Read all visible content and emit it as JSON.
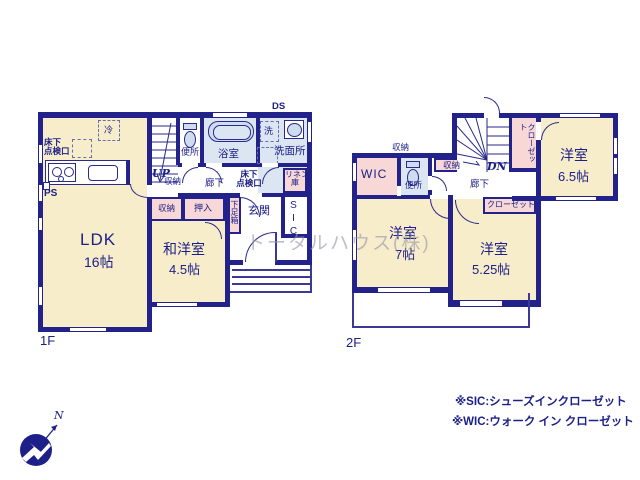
{
  "watermark": "トータルハウス(株)",
  "f1": {
    "floor_label": "1F",
    "ds": "DS",
    "rei": "冷",
    "yukashita_k_l1": "床下",
    "yukashita_k_l2": "点検口",
    "ps": "PS",
    "ldk_name": "LDK",
    "ldk_size": "16帖",
    "up": "UP",
    "shunou_stairs": "収納",
    "wc": "便所",
    "bath": "浴室",
    "laundry": "洗",
    "wash": "洗面所",
    "hall": "廊下",
    "yukashita_h_l1": "床下",
    "yukashita_h_l2": "点検口",
    "linen_l1": "リネン",
    "linen_l2": "庫",
    "shunou": "収納",
    "oshiire": "押入",
    "shoebox": "下足箱",
    "genkan": "玄関",
    "sic": "SIC",
    "wayo_name": "和洋室",
    "wayo_size": "4.5帖"
  },
  "f2": {
    "floor_label": "2F",
    "shunou_top": "収納",
    "wic": "WIC",
    "wc": "便所",
    "shunou_hall": "収納",
    "dn": "DN",
    "hall": "廊下",
    "closet_v": "クローゼット",
    "closet_h": "クローゼット",
    "room65_name": "洋室",
    "room65_size": "6.5帖",
    "room7_name": "洋室",
    "room7_size": "7帖",
    "room525_name": "洋室",
    "room525_size": "5.25帖"
  },
  "notes": {
    "sic": "※SIC:シューズインクローゼット",
    "wic": "※WIC:ウォーク イン クローゼット"
  },
  "compass_n": "N"
}
